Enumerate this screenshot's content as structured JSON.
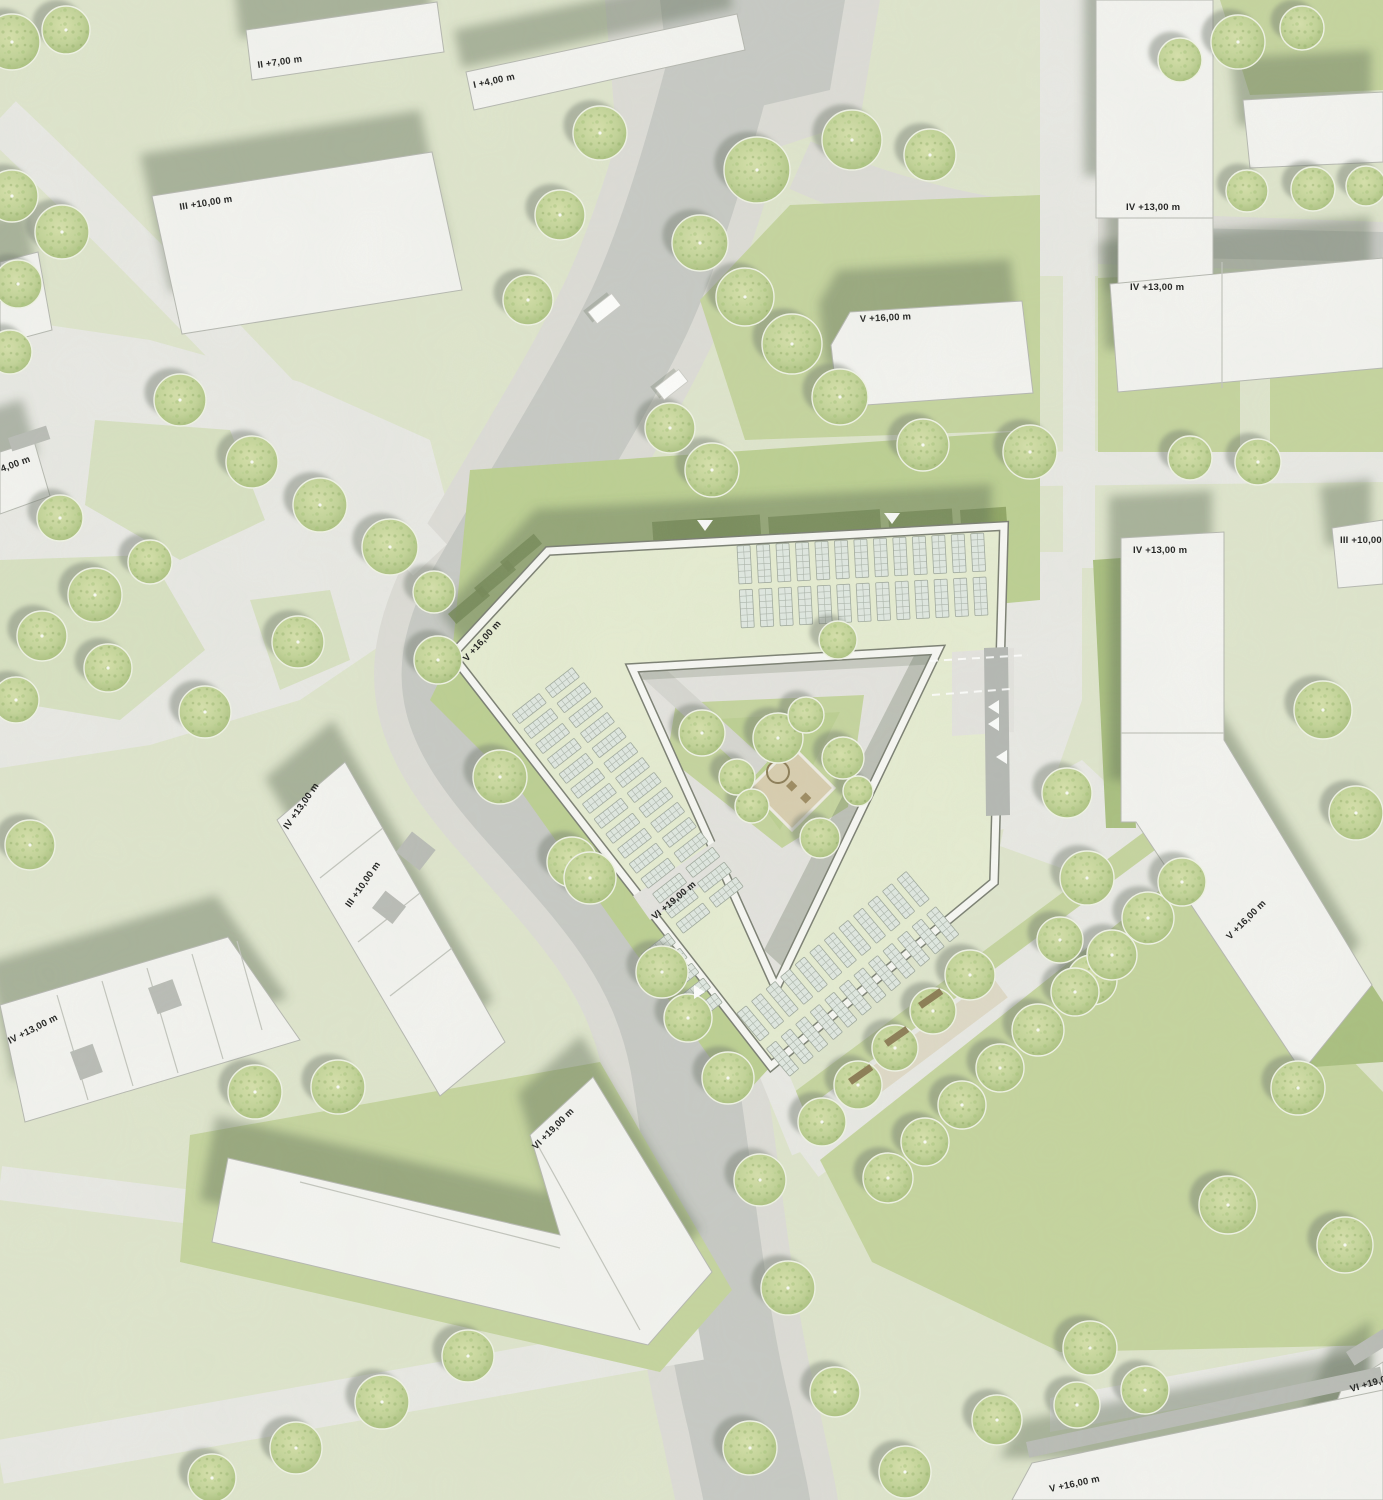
{
  "map": {
    "type": "architectural-site-plan",
    "canvas": {
      "width": 1383,
      "height": 1500
    },
    "palette": {
      "lawn_pale": "#dfe5cd",
      "lawn_soft": "#d8e1c2",
      "lawn_med": "#c5d49e",
      "lawn_bright": "#bccf92",
      "lawn_dark": "#a9bf7f",
      "hedge_dark": "#879e5c",
      "paving_light": "#e9e9e5",
      "road_side": "#dddcd7",
      "road_dark": "#c7c9c5",
      "drive_dark": "#b4b7b3",
      "court_pav": "#e4e3df",
      "building_fill": "#f4f4f1",
      "building_edge": "#b5b7b0",
      "parapet_dark": "#7a7e72",
      "parapet_light": "#f8f8f5",
      "roof_green": "#e6ecd2",
      "panel_fill": "#e0e8e2",
      "panel_line": "#9fa89d",
      "shadow": "rgba(90,104,82,0.42)",
      "tree_shadow": "rgba(110,120,108,0.45)",
      "tree_ring": "#f0f3e6",
      "sand": "#d8cdaf",
      "bench": "#8a7a52",
      "label_color": "#1c1c1c",
      "car_fill": "#fdfdfc"
    },
    "labels": [
      {
        "text": "II +7,00 m",
        "x": 258,
        "y": 68,
        "rot": -8
      },
      {
        "text": "I +4,00 m",
        "x": 474,
        "y": 88,
        "rot": -12
      },
      {
        "text": "III +10,00 m",
        "x": 180,
        "y": 210,
        "rot": -9
      },
      {
        "text": "IV +13,00 m",
        "x": 1126,
        "y": 210,
        "rot": 0
      },
      {
        "text": "IV +13,00 m",
        "x": 1130,
        "y": 290,
        "rot": 0
      },
      {
        "text": "V +16,00 m",
        "x": 860,
        "y": 322,
        "rot": -3
      },
      {
        "text": "4,00 m",
        "x": 2,
        "y": 472,
        "rot": -20
      },
      {
        "text": "IV +13,00 m",
        "x": 1133,
        "y": 553,
        "rot": 0
      },
      {
        "text": "III +10,00 m",
        "x": 1340,
        "y": 543,
        "rot": 0
      },
      {
        "text": "V +16,00 m",
        "x": 467,
        "y": 662,
        "rot": -48
      },
      {
        "text": "IV +13,00 m",
        "x": 288,
        "y": 830,
        "rot": -55
      },
      {
        "text": "III +10,00 m",
        "x": 350,
        "y": 908,
        "rot": -55
      },
      {
        "text": "IV +13,00 m",
        "x": 10,
        "y": 1044,
        "rot": -27
      },
      {
        "text": "VI +19,00 m",
        "x": 655,
        "y": 920,
        "rot": -40
      },
      {
        "text": "V +16,00 m",
        "x": 1230,
        "y": 940,
        "rot": -45
      },
      {
        "text": "VI +19,00 m",
        "x": 536,
        "y": 1150,
        "rot": -45
      },
      {
        "text": "VI +19,00 m",
        "x": 1351,
        "y": 1392,
        "rot": -16
      },
      {
        "text": "V +16,00 m",
        "x": 1050,
        "y": 1492,
        "rot": -12
      }
    ],
    "buildings": [
      {
        "id": "b-II",
        "pts": "246,30 437,2 444,52 252,80"
      },
      {
        "id": "b-I4",
        "pts": "466,72 737,14 745,50 474,110"
      },
      {
        "id": "b-III",
        "pts": "152,196 432,152 462,290 182,334"
      },
      {
        "id": "b-edge-a",
        "pts": "0,262 38,252 52,330 0,344"
      },
      {
        "id": "b-edge-4",
        "pts": "0,452 34,441 50,496 0,514",
        "patches": [
          [
            8,
            438,
            40,
            14,
            -18
          ]
        ]
      },
      {
        "id": "b-A",
        "pts": "1096,0 1213,0 1213,218 1096,218"
      },
      {
        "id": "b-A2",
        "pts": "1118,218 1213,218 1213,332 1118,332"
      },
      {
        "id": "b-B",
        "pts": "1110,284 1383,258 1383,368 1118,392",
        "lines": [
          "1222,262 1222,388"
        ]
      },
      {
        "id": "b-E",
        "pts": "1243,100 1383,92 1383,162 1250,168"
      },
      {
        "id": "b-V",
        "pts": "850,312 1022,301 1033,393 838,407 831,345"
      },
      {
        "id": "b-D",
        "pts": "1332,528 1383,520 1383,584 1338,588"
      },
      {
        "id": "b-C",
        "pts": "1121,538 1224,532 1224,740 1372,985 1302,1072 1136,822 1121,822",
        "lines": [
          "1121,733 1224,733"
        ]
      },
      {
        "id": "b-F",
        "pts": "1342,1388 1383,1362 1383,1500 1298,1500",
        "patches": [
          [
            1346,
            1352,
            46,
            16,
            -32
          ]
        ]
      },
      {
        "id": "b-G",
        "pts": "1032,1463 1383,1390 1383,1500 1012,1500",
        "patches": [
          [
            1026,
            1442,
            362,
            16,
            -12
          ]
        ]
      },
      {
        "id": "b-H",
        "pts": "345,762 505,1042 440,1096 277,820",
        "lines": [
          "383,828 320,878",
          "420,893 358,942",
          "452,948 390,996"
        ],
        "patches": [
          [
            396,
            852,
            26,
            30,
            -52
          ],
          [
            372,
            908,
            22,
            26,
            -52
          ]
        ]
      },
      {
        "id": "b-J",
        "pts": "0,1005 228,937 300,1040 25,1122",
        "lines": [
          "57,995 88,1100",
          "102,981 133,1086",
          "147,968 178,1073",
          "192,954 223,1059",
          "237,941 262,1030"
        ],
        "patches": [
          [
            70,
            1052,
            24,
            30,
            -20
          ],
          [
            148,
            988,
            26,
            28,
            -20
          ]
        ]
      },
      {
        "id": "b-K",
        "pts": "593,1077 712,1272 648,1345 212,1242 228,1158 560,1235 530,1135",
        "lines": [
          "536,1142 640,1330",
          "300,1182 560,1248"
        ]
      }
    ],
    "site": {
      "outer": "M548,551 L1004,526 L994,882 L771,1066 L452,655 Z",
      "hole": "M632,668 L938,650 L776,988 Z",
      "courtyard": {
        "pav": "626,662 946,644 778,996",
        "green": "676,703 864,695 848,807 782,848 667,757",
        "green2": "700,720 840,712 780,830",
        "path_line": [
          648,
          668,
          760,
          770
        ],
        "shadow1": "938,652 788,972 764,950 918,648",
        "shadow2": "634,668 938,652 938,664 640,680",
        "sand_diamond": "792,746 834,788 792,830 750,788",
        "play_circle": [
          778,
          772,
          11
        ],
        "play_rects": [
          [
            800,
            798,
            -45
          ],
          [
            786,
            786,
            -45
          ]
        ]
      },
      "passages": [
        {
          "pts": "952,652 1014,648 1014,732 952,736",
          "fill": "court_pav"
        },
        {
          "pts": "984,648 1008,647 1010,815 986,816",
          "fill": "drive_dark"
        },
        {
          "pts": "633,896 720,838 737,862 650,920",
          "fill": "court_pav"
        }
      ],
      "dashes": [
        [
          930,
          661,
          1028,
          655
        ],
        [
          932,
          695,
          1010,
          689
        ]
      ]
    },
    "solar_groups": [
      {
        "tx": 737,
        "ty": 546,
        "rot": -3,
        "rows": [
          {
            "x0": 0,
            "y0": 0,
            "count": 13,
            "dx": 19.5,
            "w": 13,
            "h": 38
          },
          {
            "x0": 0,
            "y0": 44,
            "count": 13,
            "dx": 19.5,
            "w": 13,
            "h": 38
          }
        ]
      },
      {
        "tx": 575,
        "ty": 655,
        "rot": 52,
        "rows": [
          {
            "x0": 8,
            "y0": 10,
            "count": 15,
            "dx": 19,
            "w": 12,
            "h": 34
          },
          {
            "x0": 8,
            "y0": 52,
            "count": 15,
            "dx": 19,
            "w": 12,
            "h": 34
          }
        ]
      },
      {
        "tx": 758,
        "ty": 1048,
        "rot": -40,
        "rows": [
          {
            "x0": 6,
            "y0": 6,
            "count": 12,
            "dx": 19,
            "w": 12,
            "h": 36
          },
          {
            "x0": 6,
            "y0": -40,
            "count": 12,
            "dx": 19,
            "w": 12,
            "h": 36
          }
        ]
      },
      {
        "tx": 672,
        "ty": 925,
        "rot": 52,
        "rows": [
          {
            "x0": 4,
            "y0": 8,
            "count": 5,
            "dx": 19,
            "w": 12,
            "h": 34
          }
        ]
      }
    ],
    "greens": [
      {
        "pts": "1220,0 1383,0 1383,90 1250,95",
        "fill": "lawn_med"
      },
      {
        "pts": "790,205 1040,195 1040,430 745,440 700,300",
        "fill": "lawn_med"
      },
      {
        "pts": "470,470 1040,430 1040,600 452,655",
        "fill": "lawn_bright"
      },
      {
        "pts": "1098,278 1240,272 1240,452 1098,452",
        "fill": "lawn_med"
      },
      {
        "pts": "1270,272 1383,268 1383,452 1270,452",
        "fill": "lawn_med"
      },
      {
        "pts": "1093,560 1121,558 1136,828 1106,828",
        "fill": "lawn_dark"
      },
      {
        "pts": "820,1160 1175,878 1383,1092 1383,1345 1060,1352 872,1262",
        "fill": "lawn_med"
      },
      {
        "pts": "1252,802 1383,1002 1383,1062 1300,1068",
        "fill": "lawn_dark"
      },
      {
        "pts": "190,1135 600,1062 732,1290 660,1372 180,1262",
        "fill": "lawn_med"
      },
      {
        "pts": "452,655 771,1066 740,1100 520,790 430,700",
        "fill": "lawn_bright"
      },
      {
        "pts": "95,420 230,430 265,520 180,560 85,505",
        "fill": "lawn_soft"
      },
      {
        "pts": "0,560 150,555 205,650 120,720 0,700",
        "fill": "lawn_soft"
      },
      {
        "pts": "250,600 330,590 350,660 280,690",
        "fill": "lawn_soft"
      }
    ],
    "hedges": [
      [
        652,
        522,
        108,
        22,
        -4
      ],
      [
        768,
        517,
        112,
        22,
        -4
      ],
      [
        888,
        513,
        64,
        22,
        -4
      ],
      [
        960,
        510,
        46,
        22,
        -4
      ],
      [
        448,
        614,
        44,
        13,
        -40
      ],
      [
        474,
        588,
        44,
        13,
        -40
      ],
      [
        500,
        562,
        44,
        13,
        -40
      ],
      [
        646,
        650,
        58,
        13,
        -3
      ],
      [
        714,
        647,
        68,
        13,
        -3
      ],
      [
        792,
        644,
        58,
        13,
        -3
      ],
      [
        862,
        641,
        48,
        13,
        -3
      ],
      [
        655,
        672,
        40,
        11,
        52
      ],
      [
        690,
        668,
        40,
        11,
        52
      ]
    ],
    "trees": [
      [
        12,
        42,
        28
      ],
      [
        66,
        30,
        24
      ],
      [
        12,
        196,
        26
      ],
      [
        62,
        232,
        27
      ],
      [
        18,
        284,
        24
      ],
      [
        10,
        352,
        22
      ],
      [
        180,
        400,
        26
      ],
      [
        252,
        462,
        26
      ],
      [
        320,
        505,
        27
      ],
      [
        390,
        547,
        28
      ],
      [
        434,
        592,
        21
      ],
      [
        95,
        595,
        27
      ],
      [
        42,
        636,
        25
      ],
      [
        108,
        668,
        24
      ],
      [
        16,
        700,
        23
      ],
      [
        205,
        712,
        26
      ],
      [
        298,
        642,
        26
      ],
      [
        150,
        562,
        22
      ],
      [
        60,
        518,
        23
      ],
      [
        438,
        660,
        24
      ],
      [
        500,
        777,
        27
      ],
      [
        572,
        862,
        25
      ],
      [
        600,
        133,
        27
      ],
      [
        560,
        215,
        25
      ],
      [
        528,
        300,
        25
      ],
      [
        757,
        170,
        33
      ],
      [
        852,
        140,
        30
      ],
      [
        930,
        155,
        26
      ],
      [
        700,
        243,
        28
      ],
      [
        745,
        297,
        29
      ],
      [
        792,
        344,
        30
      ],
      [
        840,
        397,
        28
      ],
      [
        670,
        428,
        25
      ],
      [
        712,
        470,
        27
      ],
      [
        923,
        445,
        26
      ],
      [
        1030,
        452,
        27
      ],
      [
        1238,
        42,
        27
      ],
      [
        1302,
        28,
        22
      ],
      [
        1247,
        191,
        21
      ],
      [
        1313,
        189,
        22
      ],
      [
        1366,
        186,
        20
      ],
      [
        1180,
        60,
        22
      ],
      [
        1190,
        458,
        22
      ],
      [
        1258,
        462,
        23
      ],
      [
        1323,
        710,
        29
      ],
      [
        1356,
        813,
        27
      ],
      [
        1067,
        793,
        25
      ],
      [
        1087,
        878,
        27
      ],
      [
        1060,
        940,
        23
      ],
      [
        1092,
        980,
        25
      ],
      [
        702,
        733,
        23
      ],
      [
        778,
        738,
        25
      ],
      [
        806,
        715,
        18
      ],
      [
        737,
        777,
        18
      ],
      [
        752,
        806,
        17
      ],
      [
        843,
        758,
        21
      ],
      [
        858,
        791,
        15
      ],
      [
        820,
        838,
        20
      ],
      [
        838,
        640,
        19
      ],
      [
        590,
        878,
        26
      ],
      [
        662,
        972,
        26
      ],
      [
        688,
        1018,
        24
      ],
      [
        728,
        1078,
        26
      ],
      [
        760,
        1180,
        26
      ],
      [
        788,
        1288,
        27
      ],
      [
        835,
        1392,
        25
      ],
      [
        750,
        1448,
        27
      ],
      [
        905,
        1472,
        26
      ],
      [
        970,
        975,
        25
      ],
      [
        933,
        1011,
        23
      ],
      [
        895,
        1048,
        23
      ],
      [
        858,
        1085,
        24
      ],
      [
        822,
        1122,
        24
      ],
      [
        1038,
        1030,
        26
      ],
      [
        1000,
        1068,
        24
      ],
      [
        962,
        1105,
        24
      ],
      [
        925,
        1142,
        24
      ],
      [
        888,
        1178,
        25
      ],
      [
        1075,
        992,
        24
      ],
      [
        1112,
        955,
        25
      ],
      [
        1148,
        918,
        26
      ],
      [
        1182,
        882,
        24
      ],
      [
        1228,
        1205,
        29
      ],
      [
        1298,
        1088,
        27
      ],
      [
        1345,
        1245,
        28
      ],
      [
        1090,
        1348,
        27
      ],
      [
        1145,
        1390,
        24
      ],
      [
        997,
        1420,
        25
      ],
      [
        1077,
        1405,
        23
      ],
      [
        30,
        845,
        25
      ],
      [
        255,
        1092,
        27
      ],
      [
        338,
        1087,
        27
      ],
      [
        468,
        1356,
        26
      ],
      [
        382,
        1402,
        27
      ],
      [
        296,
        1448,
        26
      ],
      [
        212,
        1478,
        24
      ]
    ],
    "cars": [
      [
        588,
        312,
        -38
      ],
      [
        655,
        388,
        -38
      ]
    ],
    "arrows": [
      {
        "x": 705,
        "y": 525,
        "d": "down"
      },
      {
        "x": 892,
        "y": 518,
        "d": "down"
      },
      {
        "x": 994,
        "y": 707,
        "d": "left"
      },
      {
        "x": 994,
        "y": 724,
        "d": "left"
      },
      {
        "x": 1002,
        "y": 757,
        "d": "left"
      },
      {
        "x": 699,
        "y": 992,
        "d": "right"
      }
    ],
    "benches": [
      [
        918,
        1003,
        -35
      ],
      [
        884,
        1041,
        -35
      ],
      [
        848,
        1079,
        -35
      ]
    ]
  }
}
